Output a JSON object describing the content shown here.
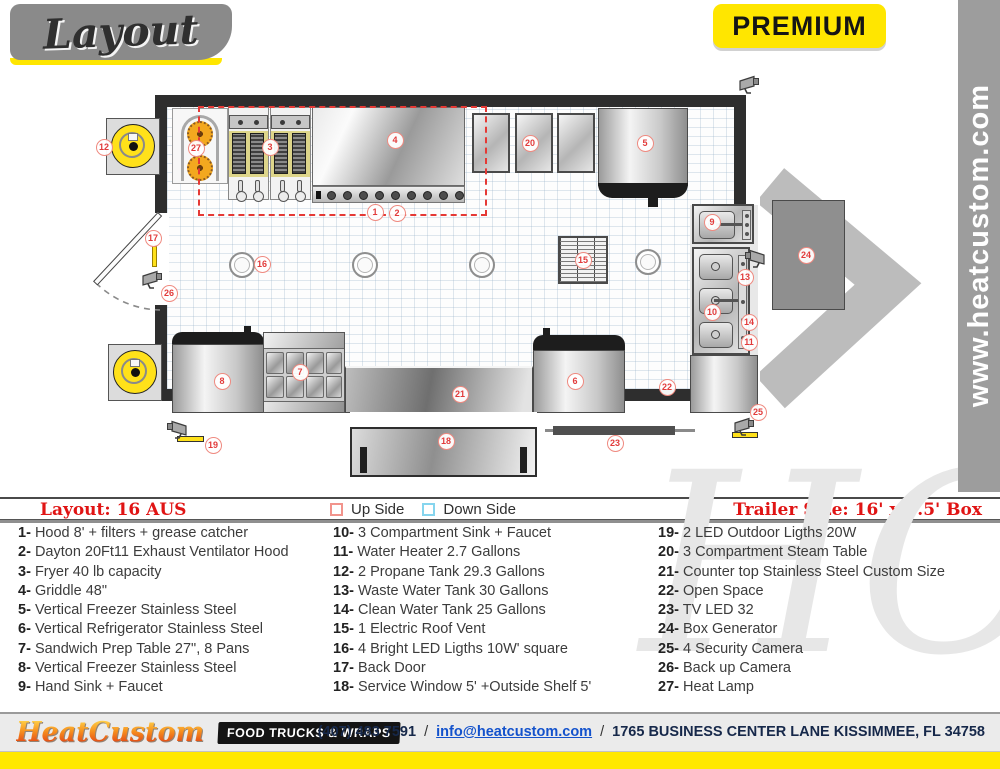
{
  "header": {
    "logo_text": "Layout",
    "badge": "PREMIUM",
    "website_vertical": "www.heatcustom.com"
  },
  "colors": {
    "accent_yellow": "#ffe600",
    "marker_red": "#e23b3b",
    "legend_red": "#e01414",
    "up_side_box": "#f2948c",
    "down_side_box": "#86d5ee",
    "wall": "#2e2e2e",
    "footer_navy": "#16284a",
    "email_blue": "#1352cc"
  },
  "legend": {
    "layout_name": "Layout: 16 AUS",
    "up_side": "Up Side",
    "down_side": "Down Side",
    "trailer_size": "Trailer Size: 16' x 8.5' Box"
  },
  "equipment": {
    "col1": [
      {
        "num": "1-",
        "text": "Hood 8' + filters + grease catcher"
      },
      {
        "num": "2-",
        "text": "Dayton 20Ft11 Exhaust Ventilator Hood"
      },
      {
        "num": "3-",
        "text": "Fryer 40 lb capacity"
      },
      {
        "num": "4-",
        "text": "Griddle 48\""
      },
      {
        "num": "5-",
        "text": "Vertical Freezer Stainless Steel"
      },
      {
        "num": "6-",
        "text": "Vertical Refrigerator Stainless Steel"
      },
      {
        "num": "7-",
        "text": "Sandwich Prep Table 27\", 8 Pans"
      },
      {
        "num": "8-",
        "text": "Vertical Freezer Stainless Steel"
      },
      {
        "num": "9-",
        "text": "Hand Sink + Faucet"
      }
    ],
    "col2": [
      {
        "num": "10-",
        "text": "3 Compartment Sink + Faucet"
      },
      {
        "num": "11-",
        "text": "Water Heater 2.7 Gallons"
      },
      {
        "num": "12-",
        "text": "2 Propane Tank 29.3 Gallons"
      },
      {
        "num": "13-",
        "text": "Waste Water Tank 30 Gallons"
      },
      {
        "num": "14-",
        "text": "Clean Water Tank 25 Gallons"
      },
      {
        "num": "15-",
        "text": "1 Electric Roof Vent"
      },
      {
        "num": "16-",
        "text": "4 Bright LED Ligths 10W' square"
      },
      {
        "num": "17-",
        "text": "Back Door"
      },
      {
        "num": "18-",
        "text": "Service Window 5' +Outside Shelf 5'"
      }
    ],
    "col3": [
      {
        "num": "19-",
        "text": "2 LED Outdoor Ligths 20W"
      },
      {
        "num": "20-",
        "text": "3 Compartment Steam Table"
      },
      {
        "num": "21-",
        "text": "Counter top Stainless Steel Custom Size"
      },
      {
        "num": "22-",
        "text": "Open Space"
      },
      {
        "num": "23-",
        "text": "TV LED 32"
      },
      {
        "num": "24-",
        "text": "Box Generator"
      },
      {
        "num": "25-",
        "text": "4 Security Camera"
      },
      {
        "num": "26-",
        "text": "Back up Camera"
      },
      {
        "num": "27-",
        "text": "Heat Lamp"
      }
    ]
  },
  "plan": {
    "markers": [
      {
        "n": "1",
        "x": 375,
        "y": 212
      },
      {
        "n": "2",
        "x": 397,
        "y": 213
      },
      {
        "n": "3",
        "x": 270,
        "y": 147
      },
      {
        "n": "4",
        "x": 395,
        "y": 140
      },
      {
        "n": "5",
        "x": 645,
        "y": 143
      },
      {
        "n": "6",
        "x": 575,
        "y": 381
      },
      {
        "n": "7",
        "x": 300,
        "y": 372
      },
      {
        "n": "8",
        "x": 222,
        "y": 381
      },
      {
        "n": "9",
        "x": 712,
        "y": 222
      },
      {
        "n": "10",
        "x": 712,
        "y": 312
      },
      {
        "n": "11",
        "x": 749,
        "y": 342
      },
      {
        "n": "12",
        "x": 104,
        "y": 147
      },
      {
        "n": "13",
        "x": 745,
        "y": 277
      },
      {
        "n": "14",
        "x": 749,
        "y": 322
      },
      {
        "n": "15",
        "x": 583,
        "y": 260
      },
      {
        "n": "16",
        "x": 262,
        "y": 264
      },
      {
        "n": "17",
        "x": 153,
        "y": 238
      },
      {
        "n": "18",
        "x": 446,
        "y": 441
      },
      {
        "n": "19",
        "x": 213,
        "y": 445
      },
      {
        "n": "20",
        "x": 530,
        "y": 143
      },
      {
        "n": "21",
        "x": 460,
        "y": 394
      },
      {
        "n": "22",
        "x": 667,
        "y": 387
      },
      {
        "n": "23",
        "x": 615,
        "y": 443
      },
      {
        "n": "24",
        "x": 806,
        "y": 255
      },
      {
        "n": "25",
        "x": 758,
        "y": 412
      },
      {
        "n": "26",
        "x": 169,
        "y": 293
      },
      {
        "n": "27",
        "x": 196,
        "y": 148
      }
    ]
  },
  "watermark": "HC",
  "footer": {
    "brand": "HeatCustom",
    "tagline": "FOOD TRUCKS & WRAPS",
    "phone": "(407) 483 7591",
    "separator": "/",
    "email": "info@heatcustom.com",
    "address": "1765 BUSINESS CENTER LANE KISSIMMEE, FL 34758"
  }
}
